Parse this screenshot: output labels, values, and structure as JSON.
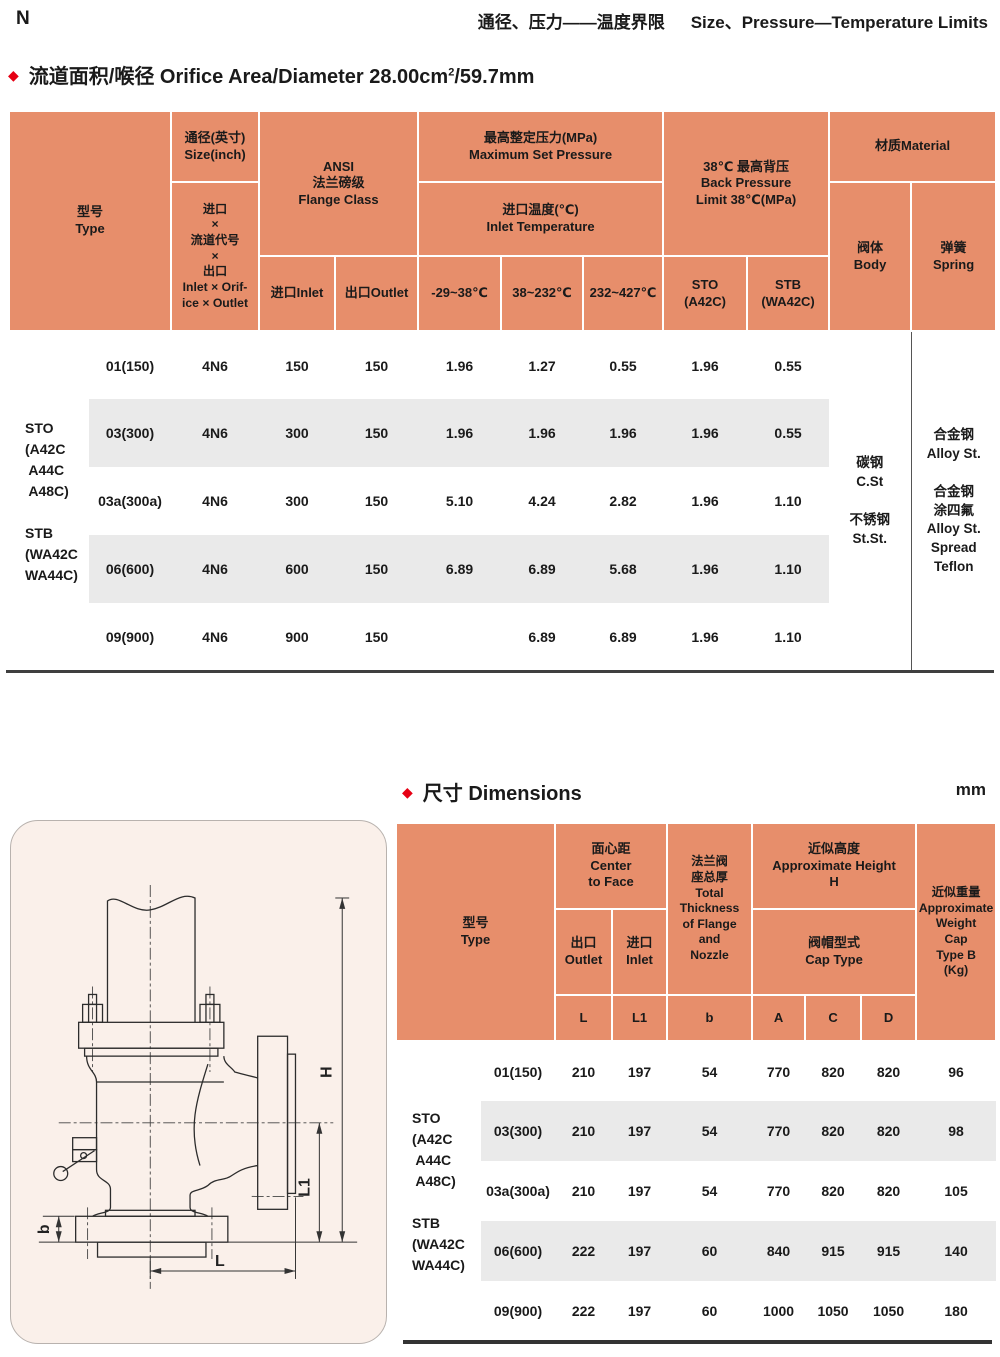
{
  "page": {
    "corner_mark": "N",
    "header": {
      "title_cn": "通径、压力——温度界限",
      "title_en": "Size、Pressure—Temperature Limits"
    },
    "section1": {
      "bullet": "◆",
      "title": "流道面积/喉径 Orifice Area/Diameter 28.00cm",
      "sup": "2",
      "tail": "/59.7mm"
    },
    "section2": {
      "bullet": "◆",
      "title": "尺寸 Dimensions",
      "unit": "mm"
    }
  },
  "colors": {
    "header_orange": "#E78E6B",
    "stripe_gray": "#EAEAEA",
    "accent_red": "#E60014",
    "panel_pink": "#FAF0EA"
  },
  "table1": {
    "header": {
      "type": "型号\nType",
      "size": "通径(英寸)\nSize(inch)",
      "size_code": "进口\n×\n流道代号\n×\n出口\nInlet × Orif-\nice × Outlet",
      "ansi": "ANSI\n法兰磅级\nFlange Class",
      "inlet": "进口Inlet",
      "outlet": "出口Outlet",
      "max_set_pressure": "最高整定压力(MPa)\nMaximum Set Pressure",
      "inlet_temp": "进口温度(℃)\nInlet Temperature",
      "t1": "-29~38℃",
      "t2": "38~232℃",
      "t3": "232~427℃",
      "back_pressure": "38℃ 最高背压\nBack Pressure\nLimit 38℃(MPa)",
      "sto": "STO\n(A42C)",
      "stb": "STB\n(WA42C)",
      "material": "材质Material",
      "body": "阀体\nBody",
      "spring": "弹簧\nSpring"
    },
    "group_label": "STO\n(A42C\n A44C\n A48C)\n\nSTB\n(WA42C\nWA44C)",
    "body_material": "碳钢\nC.St\n\n不锈钢\nSt.St.",
    "spring_material": "合金钢\nAlloy St.\n\n合金钢\n涂四氟\nAlloy St.\nSpread\nTeflon",
    "rows": [
      {
        "cells": [
          "01(150)",
          "4N6",
          "150",
          "150",
          "1.96",
          "1.27",
          "0.55",
          "1.96",
          "0.55"
        ]
      },
      {
        "cells": [
          "03(300)",
          "4N6",
          "300",
          "150",
          "1.96",
          "1.96",
          "1.96",
          "1.96",
          "0.55"
        ]
      },
      {
        "cells": [
          "03a(300a)",
          "4N6",
          "300",
          "150",
          "5.10",
          "4.24",
          "2.82",
          "1.96",
          "1.10"
        ]
      },
      {
        "cells": [
          "06(600)",
          "4N6",
          "600",
          "150",
          "6.89",
          "6.89",
          "5.68",
          "1.96",
          "1.10"
        ]
      },
      {
        "cells": [
          "09(900)",
          "4N6",
          "900",
          "150",
          "",
          "6.89",
          "6.89",
          "1.96",
          "1.10"
        ]
      }
    ]
  },
  "table2": {
    "header": {
      "type": "型号\nType",
      "center_to_face": "面心距\nCenter\nto Face",
      "outlet": "出口\nOutlet",
      "inlet": "进口\nInlet",
      "thickness": "法兰阀\n座总厚\nTotal\nThickness\nof Flange\nand\nNozzle",
      "approx_height": "近似高度\nApproximate Height\nH",
      "cap_type": "阀帽型式\nCap Type",
      "L": "L",
      "L1": "L1",
      "b": "b",
      "A": "A",
      "C": "C",
      "D": "D",
      "weight": "近似重量\nApproximate\nWeight\nCap\nType B\n(Kg)"
    },
    "group_label": "STO\n(A42C\n A44C\n A48C)\n\nSTB\n(WA42C\nWA44C)",
    "rows": [
      {
        "cells": [
          "01(150)",
          "210",
          "197",
          "54",
          "770",
          "820",
          "820",
          "96"
        ]
      },
      {
        "cells": [
          "03(300)",
          "210",
          "197",
          "54",
          "770",
          "820",
          "820",
          "98"
        ]
      },
      {
        "cells": [
          "03a(300a)",
          "210",
          "197",
          "54",
          "770",
          "820",
          "820",
          "105"
        ]
      },
      {
        "cells": [
          "06(600)",
          "222",
          "197",
          "60",
          "840",
          "915",
          "915",
          "140"
        ]
      },
      {
        "cells": [
          "09(900)",
          "222",
          "197",
          "60",
          "1000",
          "1050",
          "1050",
          "180"
        ]
      }
    ]
  },
  "drawing": {
    "dim_h": "H",
    "dim_l1": "L1",
    "dim_l": "L",
    "dim_b": "b"
  }
}
